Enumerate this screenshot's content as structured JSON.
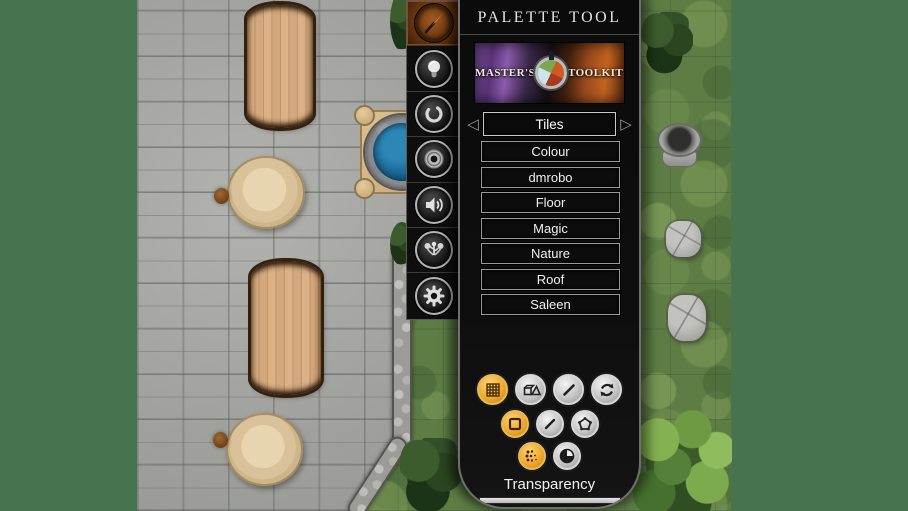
{
  "panel": {
    "title": "PALETTE TOOL",
    "banner": {
      "left_text": "MASTER'S",
      "right_text": "TOOLKIT",
      "emblem_icon": "world-emblem-icon"
    },
    "selector": {
      "value": "Tiles",
      "prev_icon": "left-arrow-icon",
      "next_icon": "right-arrow-icon",
      "prev_glyph": "◁",
      "next_glyph": "▷"
    },
    "categories": [
      "Colour",
      "dmrobo",
      "Floor",
      "Magic",
      "Nature",
      "Roof",
      "Saleen"
    ],
    "transparency": {
      "label": "Transparency",
      "value": "1.00"
    }
  },
  "toolbar": {
    "tools": [
      {
        "icon": "brush-icon",
        "active": true
      },
      {
        "icon": "lightbulb-icon",
        "active": false
      },
      {
        "icon": "ring-icon",
        "active": false
      },
      {
        "icon": "portal-icon",
        "active": false
      },
      {
        "icon": "speaker-icon",
        "active": false
      },
      {
        "icon": "scatter-plants-icon",
        "active": false
      },
      {
        "icon": "gear-icon",
        "active": false
      }
    ]
  },
  "mode_buttons": {
    "row1": [
      {
        "icon": "grid-tiles-icon",
        "active": true
      },
      {
        "icon": "shapes-icon",
        "active": false
      },
      {
        "icon": "line-icon",
        "active": false
      },
      {
        "icon": "refresh-icon",
        "active": false
      }
    ],
    "row2": [
      {
        "icon": "square-icon",
        "active": true
      },
      {
        "icon": "line-icon",
        "active": false
      },
      {
        "icon": "polygon-icon",
        "active": false
      }
    ],
    "row3": [
      {
        "icon": "halftone-icon",
        "active": true
      },
      {
        "icon": "dial-icon",
        "active": false
      }
    ]
  },
  "colors": {
    "background_green": "#48734f",
    "accent_orange": "#efa92f",
    "panel_border": "#6f6f6f",
    "water_blue": "#1d6b97"
  }
}
